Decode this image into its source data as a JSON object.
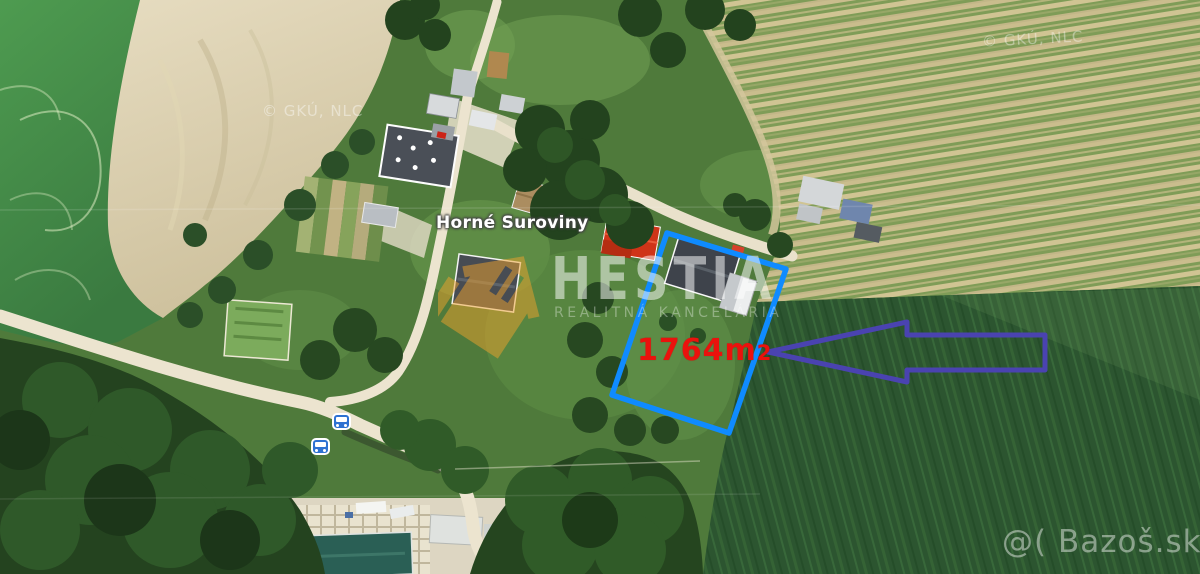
{
  "image_type": "aerial satellite photo of a land parcel for sale",
  "place_label": "Horné Suroviny",
  "parcel": {
    "area_value": "1764m",
    "area_sub": "2",
    "area_full": "1764m2",
    "outline_color": "#0f8bff",
    "label_color": "#ea120d"
  },
  "arrow": {
    "direction": "left",
    "color": "#4a43b0"
  },
  "agency_watermark": {
    "name": "HESTIA",
    "subtitle": "REALITNÁ KANCELÁRIA",
    "logo": "house-icon",
    "logo_color": "#f0a22c"
  },
  "imagery_credits": [
    {
      "text": "© GKÚ, NLC",
      "position": "top-left"
    },
    {
      "text": "© GKÚ, NLC",
      "position": "top-right"
    }
  ],
  "site_watermark": {
    "text": "@( Bazoš.sk"
  },
  "transit": {
    "icon": "bus-icon",
    "count": 2,
    "color": "#2e72d2"
  }
}
